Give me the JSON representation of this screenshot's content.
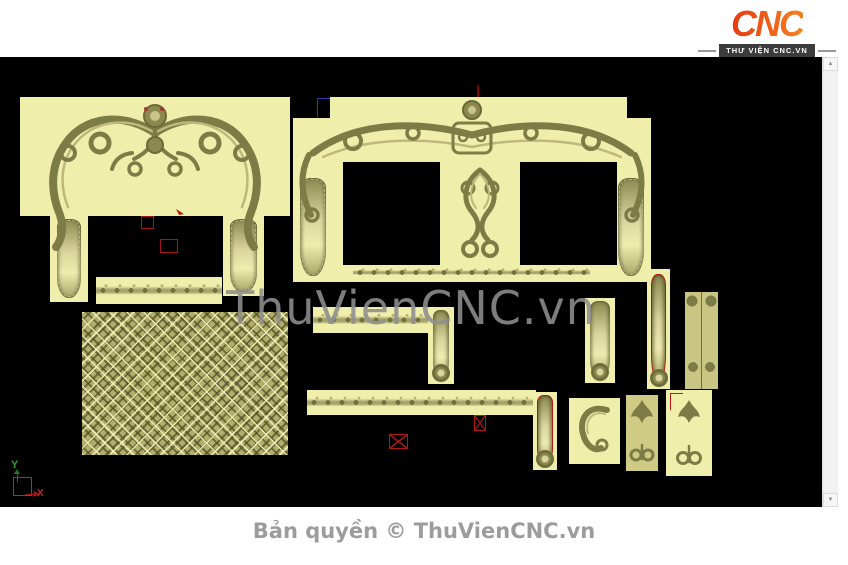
{
  "header": {
    "logo_text": "CNC",
    "logo_tagline": "THƯ VIỆN CNC.VN"
  },
  "canvas": {
    "watermark": "ThuVienCNC.vn"
  },
  "axis": {
    "y_label": "Y",
    "x_label": "X"
  },
  "scrollbar": {
    "up": "▲",
    "down": "▼"
  },
  "footer": {
    "copyright": "Bản quyền © ThuVienCNC.vn"
  },
  "colors": {
    "canvas_bg": "#000000",
    "piece_bg": "#f0eeab",
    "relief_dark": "#6b6a38",
    "relief_mid": "#7e7c46",
    "relief_light": "#c6c287",
    "selection_red": "#aa1515",
    "axis_green": "#1d8a1d",
    "logo_red": "#e63913",
    "logo_orange": "#f58220",
    "watermark_gray": "#8f8f8f",
    "footer_gray": "#9c9c9c"
  }
}
